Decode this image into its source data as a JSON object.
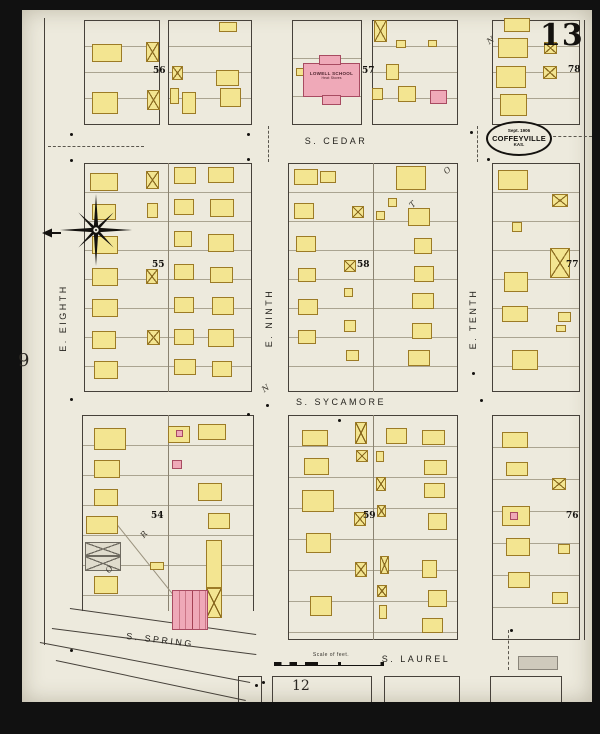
{
  "sheet": {
    "number": "13",
    "adjacent_left": "9",
    "adjacent_bottom": "12",
    "stamp": {
      "date": "Sept. 1906",
      "city": "COFFEYVILLE",
      "state": "KAS."
    },
    "scale_label": "Scale of feet."
  },
  "streets": {
    "cedar": "S. CEDAR",
    "sycamore": "S. SYCAMORE",
    "laurel": "S. LAUREL",
    "spring": "S. SPRING",
    "eighth": "E. EIGHTH",
    "ninth": "E. NINTH",
    "tenth": "E. TENTH"
  },
  "school": {
    "name": "LOWELL SCHOOL",
    "note": "Heat: Stoves"
  },
  "legend_colors": {
    "frame": "#f3e591",
    "brick": "#efa9b8",
    "paper": "#edeadd"
  },
  "map": {
    "block_numbers": [
      {
        "n": "56",
        "x": 153,
        "y": 66
      },
      {
        "n": "57",
        "x": 362,
        "y": 66
      },
      {
        "n": "78",
        "x": 568,
        "y": 65
      },
      {
        "n": "55",
        "x": 152,
        "y": 260
      },
      {
        "n": "58",
        "x": 357,
        "y": 260
      },
      {
        "n": "77",
        "x": 566,
        "y": 260
      },
      {
        "n": "54",
        "x": 151,
        "y": 511
      },
      {
        "n": "59",
        "x": 363,
        "y": 511
      },
      {
        "n": "76",
        "x": 566,
        "y": 511
      }
    ],
    "blocks": [
      {
        "x": 84,
        "y": 20,
        "w": 76,
        "h": 105,
        "lot": 26,
        "center": false,
        "nb": false
      },
      {
        "x": 168,
        "y": 20,
        "w": 84,
        "h": 105,
        "lot": 26,
        "center": false,
        "nb": false
      },
      {
        "x": 292,
        "y": 20,
        "w": 70,
        "h": 105,
        "lot": 38,
        "center": false,
        "nb": false
      },
      {
        "x": 372,
        "y": 20,
        "w": 86,
        "h": 105,
        "lot": 26,
        "center": false,
        "nb": false
      },
      {
        "x": 492,
        "y": 20,
        "w": 88,
        "h": 105,
        "lot": 26,
        "center": false,
        "nb": false
      },
      {
        "x": 84,
        "y": 163,
        "w": 168,
        "h": 229,
        "lot": 29,
        "center": true,
        "nb": false
      },
      {
        "x": 288,
        "y": 163,
        "w": 170,
        "h": 229,
        "lot": 29,
        "center": true,
        "nb": false
      },
      {
        "x": 492,
        "y": 163,
        "w": 88,
        "h": 229,
        "lot": 29,
        "center": false,
        "nb": false
      },
      {
        "x": 82,
        "y": 415,
        "w": 172,
        "h": 196,
        "lot": 30,
        "center": true,
        "nb": true
      },
      {
        "x": 288,
        "y": 415,
        "w": 170,
        "h": 225,
        "lot": 31,
        "center": true,
        "nb": false
      },
      {
        "x": 492,
        "y": 415,
        "w": 88,
        "h": 225,
        "lot": 32,
        "center": false,
        "nb": false
      },
      {
        "x": 238,
        "y": 676,
        "w": 24,
        "h": 26,
        "lot": 0,
        "center": false,
        "nb": true
      },
      {
        "x": 272,
        "y": 676,
        "w": 100,
        "h": 26,
        "lot": 0,
        "center": false,
        "nb": true
      },
      {
        "x": 384,
        "y": 676,
        "w": 76,
        "h": 26,
        "lot": 0,
        "center": false,
        "nb": true
      },
      {
        "x": 490,
        "y": 676,
        "w": 72,
        "h": 26,
        "lot": 0,
        "center": false,
        "nb": true
      }
    ],
    "buildings": [
      [
        92,
        44,
        30,
        18,
        "f"
      ],
      [
        146,
        42,
        13,
        20,
        "x"
      ],
      [
        92,
        92,
        26,
        22,
        "f"
      ],
      [
        147,
        90,
        13,
        20,
        "x"
      ],
      [
        219,
        22,
        18,
        10,
        "f"
      ],
      [
        172,
        66,
        11,
        14,
        "x"
      ],
      [
        216,
        70,
        23,
        16,
        "f"
      ],
      [
        170,
        88,
        9,
        16,
        "f"
      ],
      [
        182,
        92,
        14,
        22,
        "f"
      ],
      [
        220,
        88,
        21,
        19,
        "f"
      ],
      [
        296,
        68,
        8,
        8,
        "f"
      ],
      [
        374,
        20,
        13,
        22,
        "x"
      ],
      [
        396,
        40,
        10,
        8,
        "f"
      ],
      [
        386,
        64,
        13,
        16,
        "f"
      ],
      [
        428,
        40,
        9,
        7,
        "f"
      ],
      [
        398,
        86,
        18,
        16,
        "f"
      ],
      [
        430,
        90,
        17,
        14,
        "b"
      ],
      [
        372,
        88,
        11,
        12,
        "f"
      ],
      [
        504,
        18,
        26,
        14,
        "f"
      ],
      [
        498,
        38,
        30,
        20,
        "f"
      ],
      [
        544,
        42,
        13,
        12,
        "x"
      ],
      [
        496,
        66,
        30,
        22,
        "f"
      ],
      [
        543,
        66,
        14,
        13,
        "x"
      ],
      [
        500,
        94,
        27,
        22,
        "f"
      ],
      [
        90,
        173,
        28,
        18,
        "f"
      ],
      [
        146,
        171,
        13,
        18,
        "x"
      ],
      [
        174,
        167,
        22,
        17,
        "f"
      ],
      [
        208,
        167,
        26,
        16,
        "f"
      ],
      [
        92,
        204,
        24,
        16,
        "f"
      ],
      [
        147,
        203,
        11,
        15,
        "f"
      ],
      [
        174,
        199,
        20,
        16,
        "f"
      ],
      [
        210,
        199,
        24,
        18,
        "f"
      ],
      [
        92,
        236,
        26,
        18,
        "f"
      ],
      [
        174,
        231,
        18,
        16,
        "f"
      ],
      [
        208,
        234,
        26,
        18,
        "f"
      ],
      [
        92,
        268,
        26,
        18,
        "f"
      ],
      [
        146,
        269,
        12,
        15,
        "x"
      ],
      [
        174,
        264,
        20,
        16,
        "f"
      ],
      [
        210,
        267,
        23,
        16,
        "f"
      ],
      [
        92,
        299,
        26,
        18,
        "f"
      ],
      [
        174,
        297,
        20,
        16,
        "f"
      ],
      [
        212,
        297,
        22,
        18,
        "f"
      ],
      [
        92,
        331,
        24,
        18,
        "f"
      ],
      [
        147,
        330,
        13,
        15,
        "x"
      ],
      [
        174,
        329,
        20,
        16,
        "f"
      ],
      [
        208,
        329,
        26,
        18,
        "f"
      ],
      [
        94,
        361,
        24,
        18,
        "f"
      ],
      [
        174,
        359,
        22,
        16,
        "f"
      ],
      [
        212,
        361,
        20,
        16,
        "f"
      ],
      [
        294,
        169,
        24,
        16,
        "f"
      ],
      [
        320,
        171,
        16,
        12,
        "f"
      ],
      [
        396,
        166,
        30,
        24,
        "f"
      ],
      [
        388,
        198,
        9,
        9,
        "f"
      ],
      [
        294,
        203,
        20,
        16,
        "f"
      ],
      [
        352,
        206,
        12,
        12,
        "x"
      ],
      [
        376,
        211,
        9,
        9,
        "f"
      ],
      [
        408,
        208,
        22,
        18,
        "f"
      ],
      [
        296,
        236,
        20,
        16,
        "f"
      ],
      [
        414,
        238,
        18,
        16,
        "f"
      ],
      [
        298,
        268,
        18,
        14,
        "f"
      ],
      [
        344,
        260,
        12,
        12,
        "x"
      ],
      [
        414,
        266,
        20,
        16,
        "f"
      ],
      [
        298,
        299,
        20,
        16,
        "f"
      ],
      [
        344,
        288,
        9,
        9,
        "f"
      ],
      [
        412,
        293,
        22,
        16,
        "f"
      ],
      [
        298,
        330,
        18,
        14,
        "f"
      ],
      [
        344,
        320,
        12,
        12,
        "f"
      ],
      [
        412,
        323,
        20,
        16,
        "f"
      ],
      [
        346,
        350,
        13,
        11,
        "f"
      ],
      [
        408,
        350,
        22,
        16,
        "f"
      ],
      [
        498,
        170,
        30,
        20,
        "f"
      ],
      [
        552,
        194,
        16,
        13,
        "x"
      ],
      [
        512,
        222,
        10,
        10,
        "f"
      ],
      [
        550,
        248,
        20,
        30,
        "x"
      ],
      [
        504,
        272,
        24,
        20,
        "f"
      ],
      [
        502,
        306,
        26,
        16,
        "f"
      ],
      [
        558,
        312,
        13,
        10,
        "f"
      ],
      [
        556,
        325,
        10,
        7,
        "f"
      ],
      [
        512,
        350,
        26,
        20,
        "f"
      ],
      [
        94,
        428,
        32,
        22,
        "f"
      ],
      [
        168,
        426,
        22,
        17,
        "f"
      ],
      [
        176,
        430,
        7,
        7,
        "b"
      ],
      [
        198,
        424,
        28,
        16,
        "f"
      ],
      [
        94,
        460,
        26,
        18,
        "f"
      ],
      [
        172,
        460,
        10,
        9,
        "b"
      ],
      [
        94,
        489,
        24,
        17,
        "f"
      ],
      [
        198,
        483,
        24,
        18,
        "f"
      ],
      [
        86,
        516,
        32,
        18,
        "f"
      ],
      [
        208,
        513,
        22,
        16,
        "f"
      ],
      [
        85,
        542,
        36,
        14,
        "g"
      ],
      [
        85,
        556,
        36,
        15,
        "g"
      ],
      [
        150,
        562,
        14,
        8,
        "f"
      ],
      [
        94,
        576,
        24,
        18,
        "f"
      ],
      [
        206,
        540,
        16,
        48,
        "f"
      ],
      [
        206,
        588,
        16,
        30,
        "x"
      ],
      [
        302,
        430,
        26,
        16,
        "f"
      ],
      [
        304,
        458,
        25,
        17,
        "f"
      ],
      [
        302,
        490,
        32,
        22,
        "f"
      ],
      [
        306,
        533,
        25,
        20,
        "f"
      ],
      [
        310,
        596,
        22,
        20,
        "f"
      ],
      [
        355,
        422,
        12,
        22,
        "x"
      ],
      [
        356,
        450,
        12,
        12,
        "x"
      ],
      [
        354,
        512,
        12,
        14,
        "x"
      ],
      [
        355,
        562,
        12,
        15,
        "x"
      ],
      [
        386,
        428,
        21,
        16,
        "f"
      ],
      [
        422,
        430,
        23,
        15,
        "f"
      ],
      [
        424,
        460,
        23,
        15,
        "f"
      ],
      [
        376,
        451,
        8,
        11,
        "f"
      ],
      [
        376,
        477,
        10,
        14,
        "x"
      ],
      [
        424,
        483,
        21,
        15,
        "f"
      ],
      [
        377,
        505,
        9,
        12,
        "x"
      ],
      [
        428,
        513,
        19,
        17,
        "f"
      ],
      [
        380,
        556,
        9,
        18,
        "x"
      ],
      [
        422,
        560,
        15,
        18,
        "f"
      ],
      [
        377,
        585,
        10,
        12,
        "x"
      ],
      [
        428,
        590,
        19,
        17,
        "f"
      ],
      [
        379,
        605,
        8,
        14,
        "f"
      ],
      [
        422,
        618,
        21,
        15,
        "f"
      ],
      [
        502,
        432,
        26,
        16,
        "f"
      ],
      [
        506,
        462,
        22,
        14,
        "f"
      ],
      [
        552,
        478,
        14,
        12,
        "x"
      ],
      [
        502,
        506,
        28,
        20,
        "f"
      ],
      [
        510,
        512,
        8,
        8,
        "b"
      ],
      [
        506,
        538,
        24,
        18,
        "f"
      ],
      [
        558,
        544,
        12,
        10,
        "f"
      ],
      [
        508,
        572,
        22,
        16,
        "f"
      ],
      [
        552,
        592,
        16,
        12,
        "f"
      ]
    ],
    "letters": [
      [
        "N",
        487,
        36,
        -35
      ],
      [
        "N",
        262,
        384,
        -35
      ],
      [
        "T",
        410,
        200,
        -45
      ],
      [
        "O",
        444,
        166,
        -40
      ],
      [
        "R",
        141,
        530,
        -50
      ],
      [
        "O",
        106,
        565,
        -50
      ]
    ],
    "dots": [
      [
        70,
        133
      ],
      [
        247,
        133
      ],
      [
        470,
        131
      ],
      [
        487,
        158
      ],
      [
        70,
        159
      ],
      [
        247,
        158
      ],
      [
        70,
        398
      ],
      [
        266,
        404
      ],
      [
        480,
        399
      ],
      [
        70,
        649
      ],
      [
        510,
        629
      ],
      [
        262,
        681
      ],
      [
        472,
        372
      ],
      [
        255,
        684
      ],
      [
        338,
        419
      ],
      [
        247,
        413
      ]
    ],
    "dashes": [
      [
        48,
        146,
        96,
        0
      ],
      [
        268,
        126,
        36,
        1
      ],
      [
        477,
        126,
        36,
        1
      ],
      [
        548,
        136,
        44,
        0
      ],
      [
        508,
        630,
        40,
        1
      ]
    ],
    "lines": [
      [
        44,
        18,
        627,
        1
      ],
      [
        584,
        20,
        620,
        1
      ]
    ],
    "diagonals": [
      [
        70,
        608,
        256,
        634,
        0
      ],
      [
        52,
        628,
        256,
        654,
        0
      ],
      [
        40,
        642,
        250,
        682,
        0
      ],
      [
        56,
        660,
        246,
        700,
        0
      ],
      [
        118,
        525,
        190,
        615,
        1
      ]
    ]
  }
}
